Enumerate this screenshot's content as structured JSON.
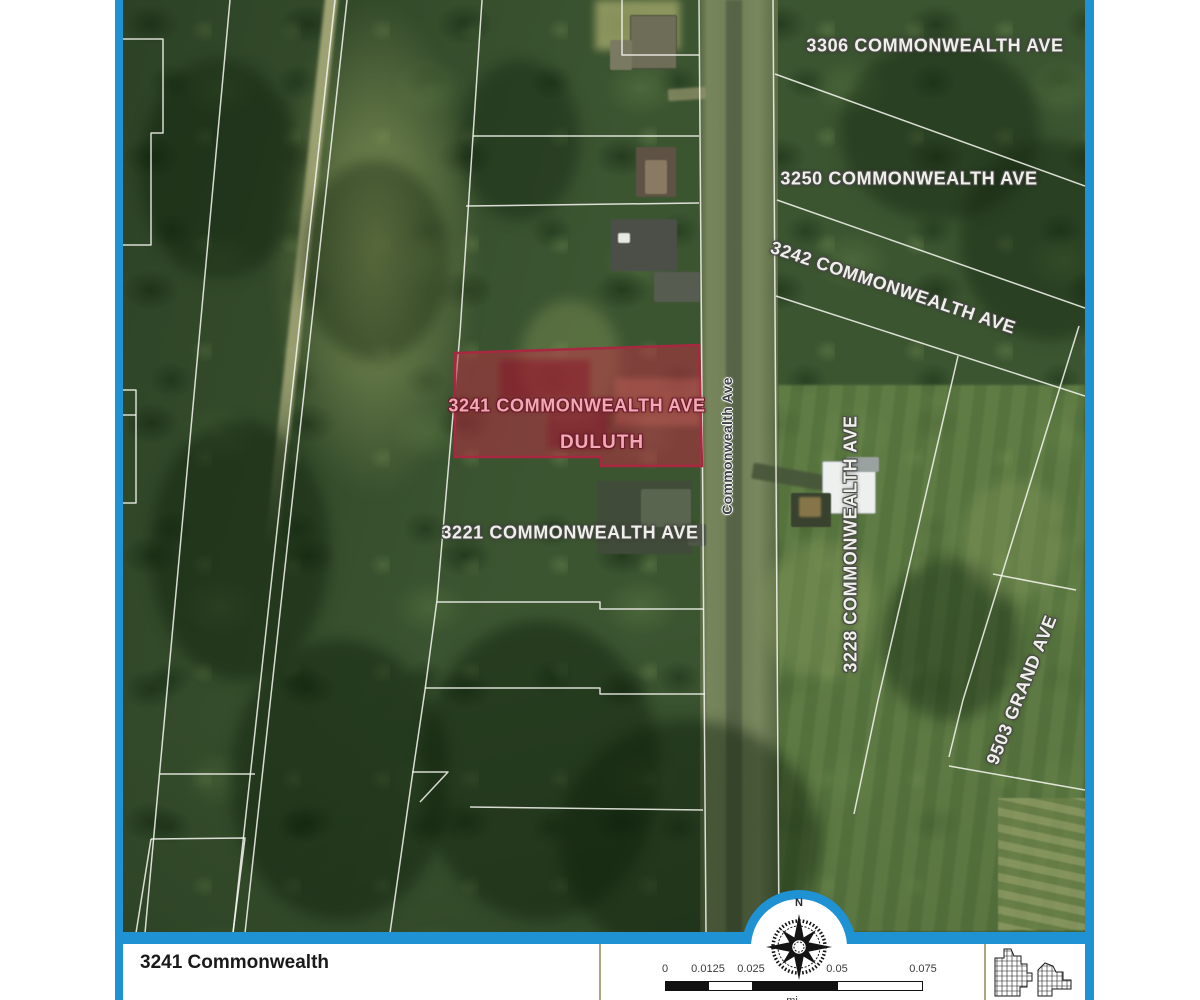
{
  "map": {
    "parcel_labels": [
      "3306 COMMONWEALTH AVE",
      "3250 COMMONWEALTH AVE",
      "3242 COMMONWEALTH AVE",
      "3221 COMMONWEALTH AVE",
      "3228 COMMONWEALTH AVE",
      "9503 GRAND AVE"
    ],
    "street_label": "Commonwealth Ave",
    "highlighted_parcel": {
      "address_label": "3241 COMMONWEALTH AVE",
      "city_label": "DULUTH",
      "highlight_color": "#c12b44"
    }
  },
  "footer": {
    "title": "3241 Commonwealth",
    "compass": {
      "north_label": "N"
    },
    "scale_bar": {
      "tick_labels": [
        "0",
        "0.0125",
        "0.025",
        "0.05",
        "0.075"
      ],
      "unit_label": "mi"
    }
  },
  "frame": {
    "border_color": "#1f92d4"
  }
}
